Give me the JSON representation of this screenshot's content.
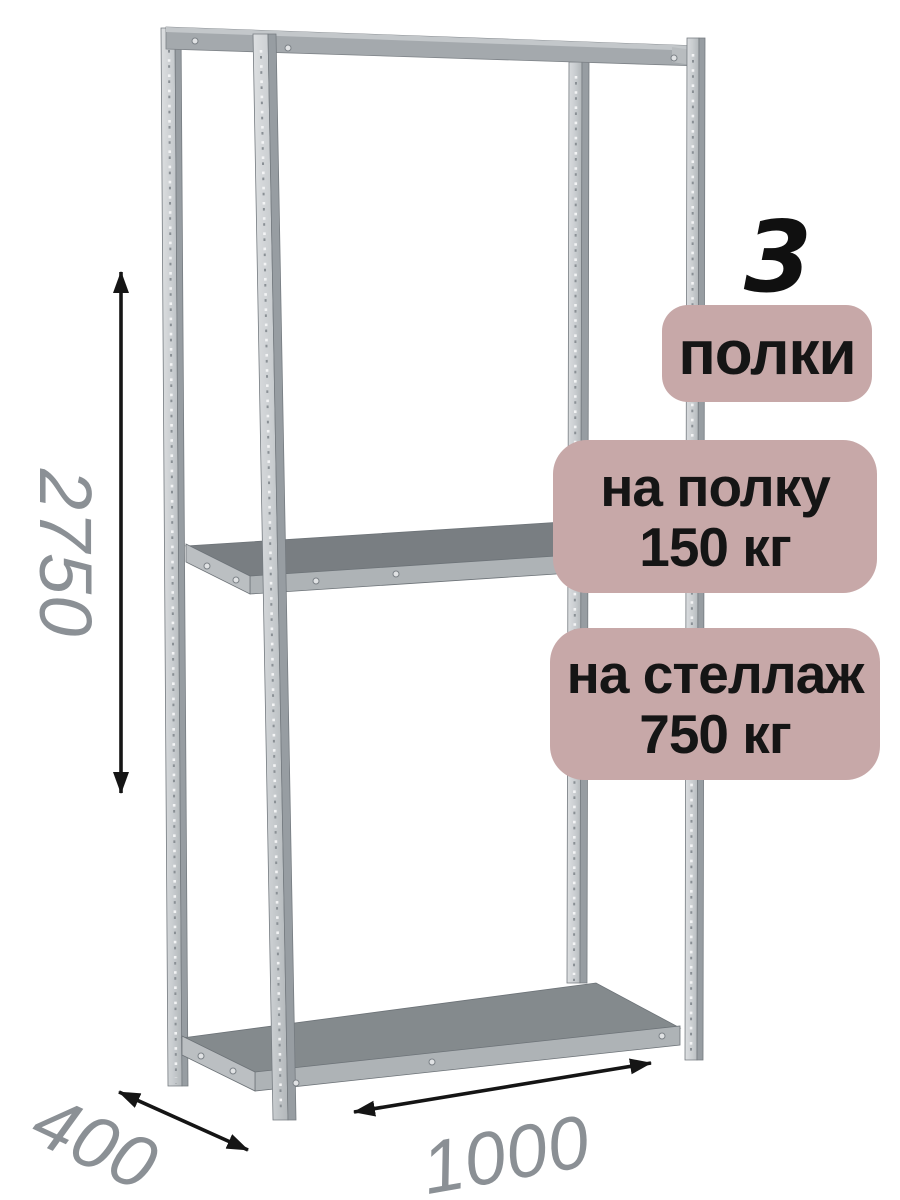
{
  "annotations": {
    "shelf_count": "3",
    "shelf_count_unit": "полки",
    "per_shelf_line1": "на полку",
    "per_shelf_line2": "150 кг",
    "per_rack_line1": "на стеллаж",
    "per_rack_line2": "750 кг"
  },
  "dimensions": {
    "height": "2750",
    "depth": "400",
    "width": "1000"
  },
  "colors": {
    "badge_background": "#c7a8a8",
    "badge_text": "#151515",
    "dimension_text": "#8b9095",
    "arrow": "#151515",
    "metal_light": "#cdd1d4",
    "metal_mid": "#a4a9ad",
    "metal_shelf_top": "#84898c",
    "background": "#ffffff"
  }
}
